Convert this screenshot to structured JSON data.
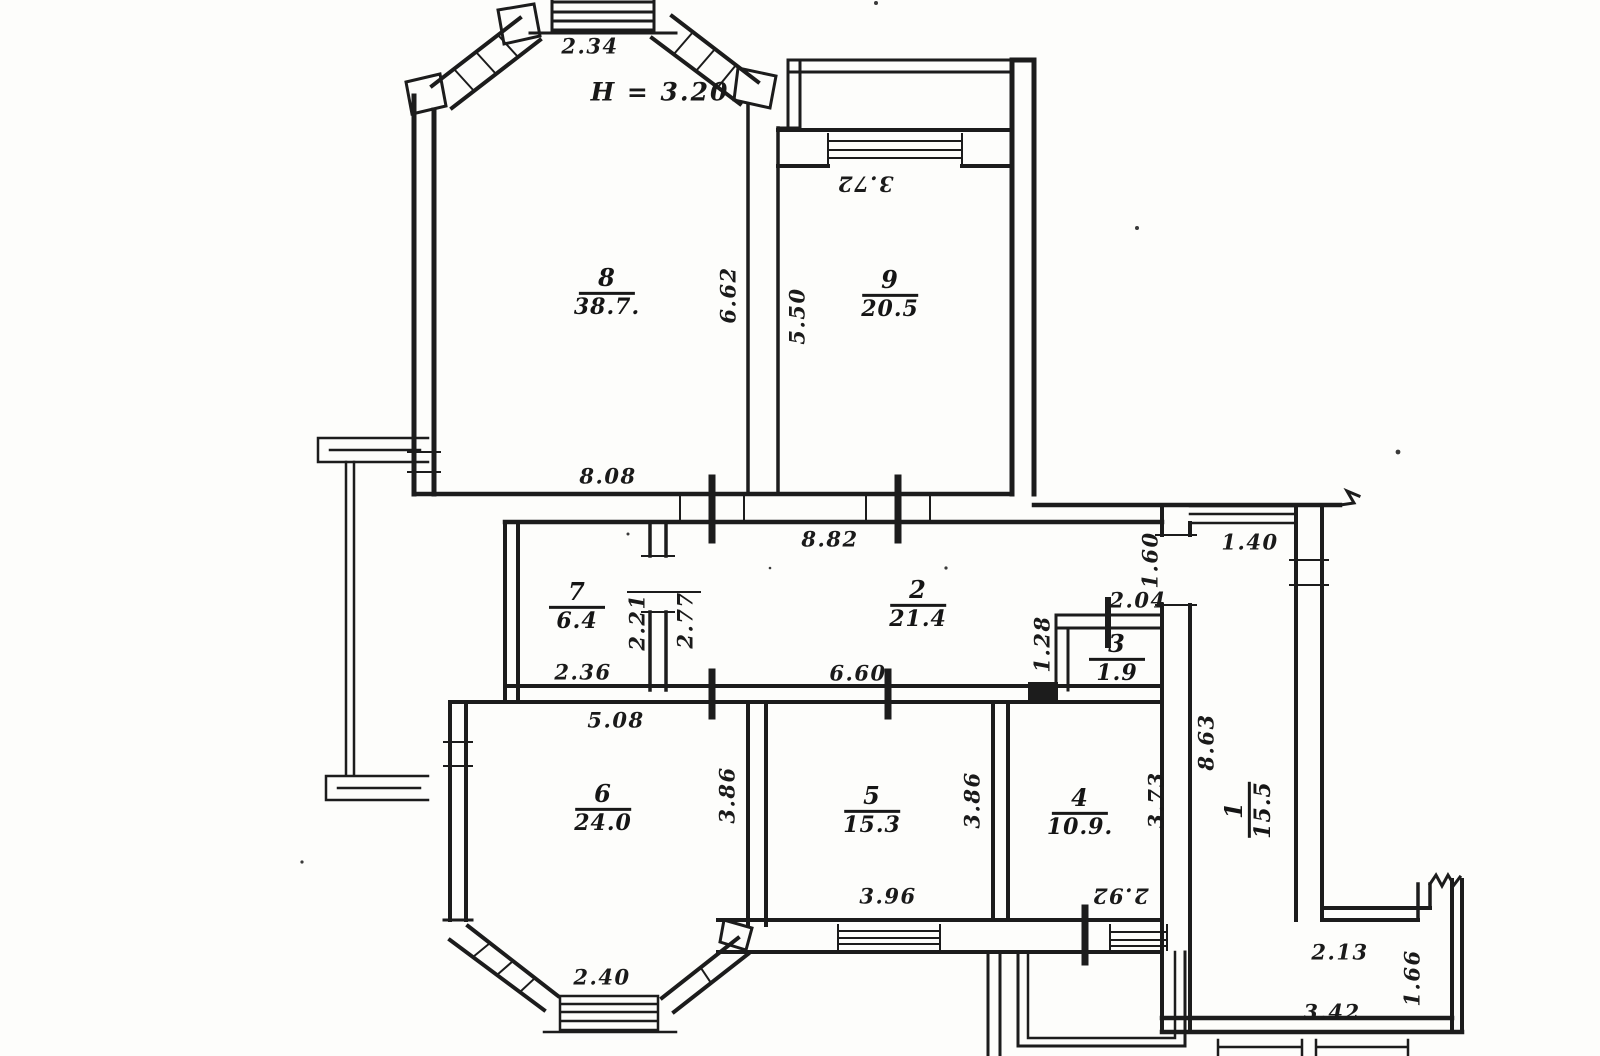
{
  "plan_name": "apartment-floor-plan-scan",
  "ceiling_height_label": "H = 3.20",
  "rooms": {
    "r1": {
      "number": "1",
      "area": "15.5"
    },
    "r2": {
      "number": "2",
      "area": "21.4"
    },
    "r3": {
      "number": "3",
      "area": "1.9"
    },
    "r4": {
      "number": "4",
      "area": "10.9."
    },
    "r5": {
      "number": "5",
      "area": "15.3"
    },
    "r6": {
      "number": "6",
      "area": "24.0"
    },
    "r7": {
      "number": "7",
      "area": "6.4"
    },
    "r8": {
      "number": "8",
      "area": "38.7."
    },
    "r9": {
      "number": "9",
      "area": "20.5"
    }
  },
  "dims": {
    "d234": "2.34",
    "d372": "3.72",
    "d662": "6.62",
    "d550": "5.50",
    "d808": "8.08",
    "d882": "8.82",
    "d236": "2.36",
    "d221": "2.21",
    "d277": "2.77",
    "d660": "6.60",
    "d204": "2.04",
    "d128": "1.28",
    "d160": "1.60",
    "d140": "1.40",
    "d508": "5.08",
    "d386a": "3.86",
    "d386b": "3.86",
    "d373": "3.73",
    "d863": "8.63",
    "d396": "3.96",
    "d292": "2.92",
    "d240": "2.40",
    "d213": "2.13",
    "d166": "1.66",
    "d342": "3.42"
  }
}
